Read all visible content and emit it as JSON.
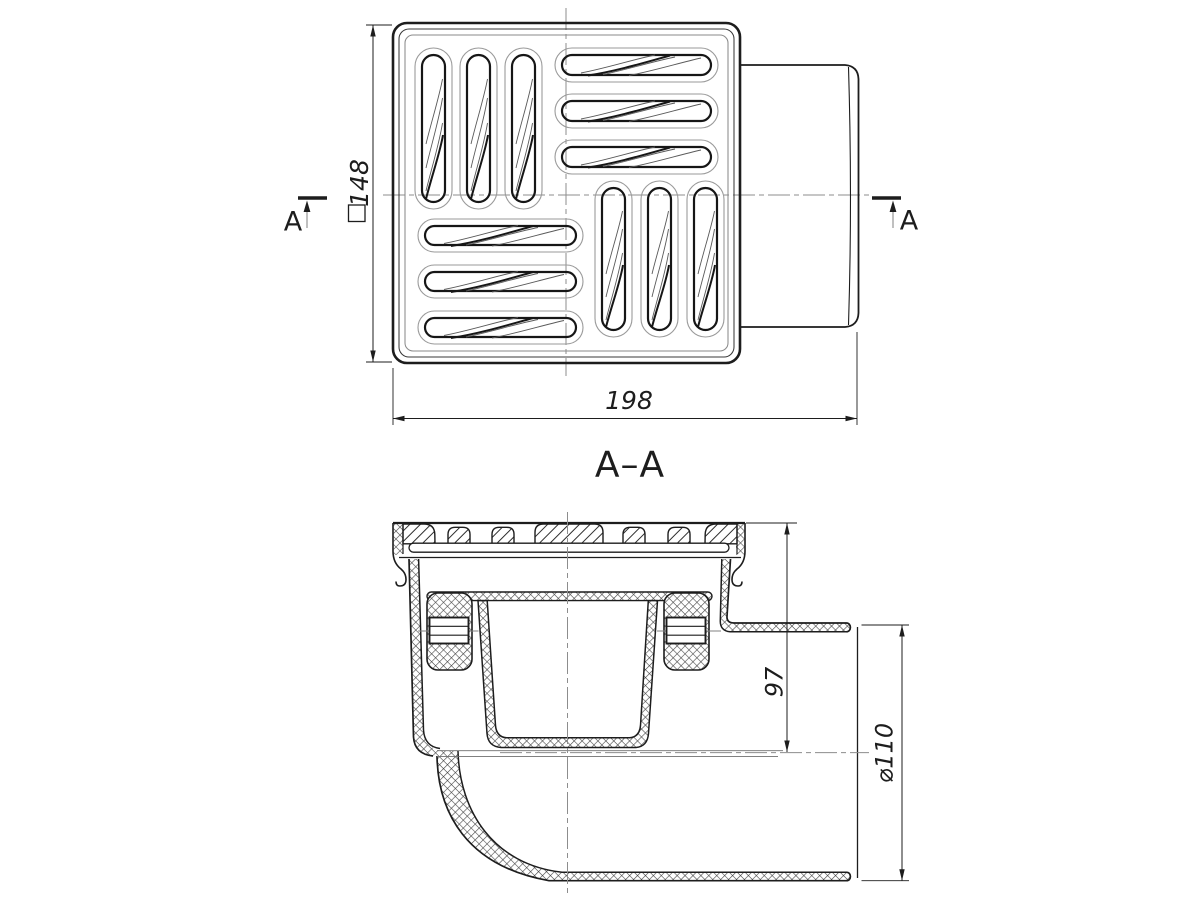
{
  "drawing": {
    "section_title": "A–A",
    "section_letter": "A",
    "dims": {
      "square_side": "148",
      "overall_width": "198",
      "outlet_depth": "97",
      "outlet_diameter": "⌀110"
    },
    "colors": {
      "line": "#1d1d1d",
      "centerline": "#8d8d8d",
      "background": "#ffffff"
    }
  }
}
